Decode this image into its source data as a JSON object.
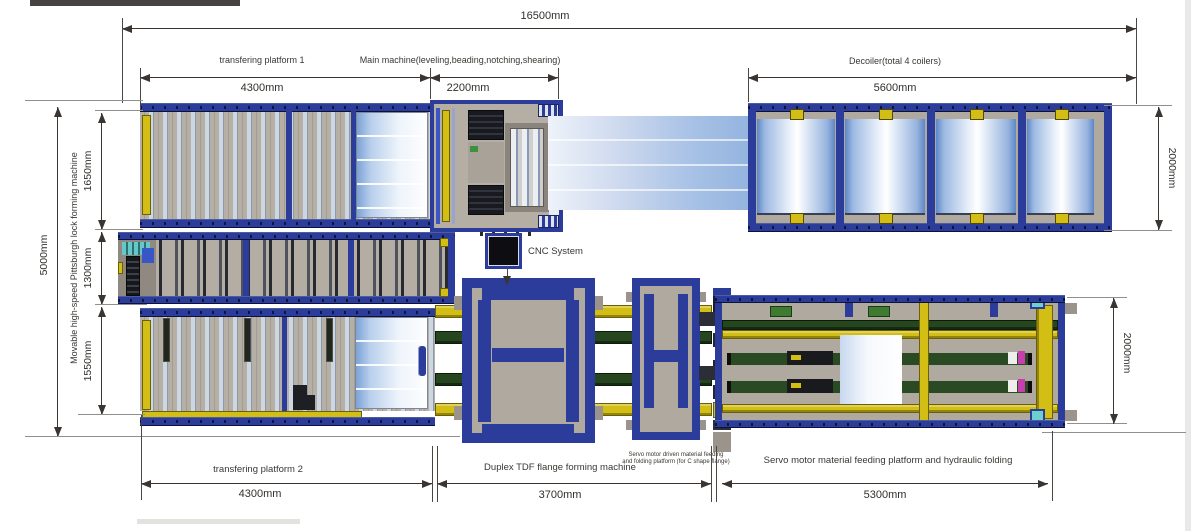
{
  "drawing": {
    "kind": "machine-line layout plan (top view)",
    "dims": {
      "overall_length": "16500mm",
      "overall_width": "5000mm",
      "platform1_length": "4300mm",
      "main_machine_length": "2200mm",
      "decoiler_length": "5600mm",
      "decoiler_width": "2000mm",
      "row_top_width": "1650mm",
      "row_middle_width": "1300mm",
      "row_bottom_width": "1550mm",
      "platform2_length": "4300mm",
      "duplex_tdf_length": "3700mm",
      "servo_platform_length": "5300mm",
      "servo_platform_width": "2000mm"
    },
    "labels": {
      "platform1": "transfering platform 1",
      "main_machine": "Main machine(leveling,beading,notching,shearing)",
      "decoiler": "Decoiler(total 4 coilers)",
      "pittsburgh": "Movable high-speed Pittsburgh lock forming machine",
      "cnc": "CNC System",
      "platform2": "transfering platform 2",
      "duplex_tdf": "Duplex TDF flange forming machine",
      "servo_note_line1": "Servo motor driven material feeding",
      "servo_note_line2": "and folding platform (for C shape flange)",
      "servo_platform": "Servo motor material feeding platform and hydraulic folding"
    },
    "colors": {
      "frame_blue": "#2b3c9a",
      "body_gray": "#b2aba2",
      "roller_blue": "#cdd7e1",
      "accent_yellow": "#d2be14",
      "rail_green": "#25461f",
      "sheet_blue": "#93b4df",
      "teal": "#6ecfcf",
      "magenta": "#c73fae",
      "line_dark": "#3a3531",
      "line_gray": "#8f8f8f"
    }
  }
}
